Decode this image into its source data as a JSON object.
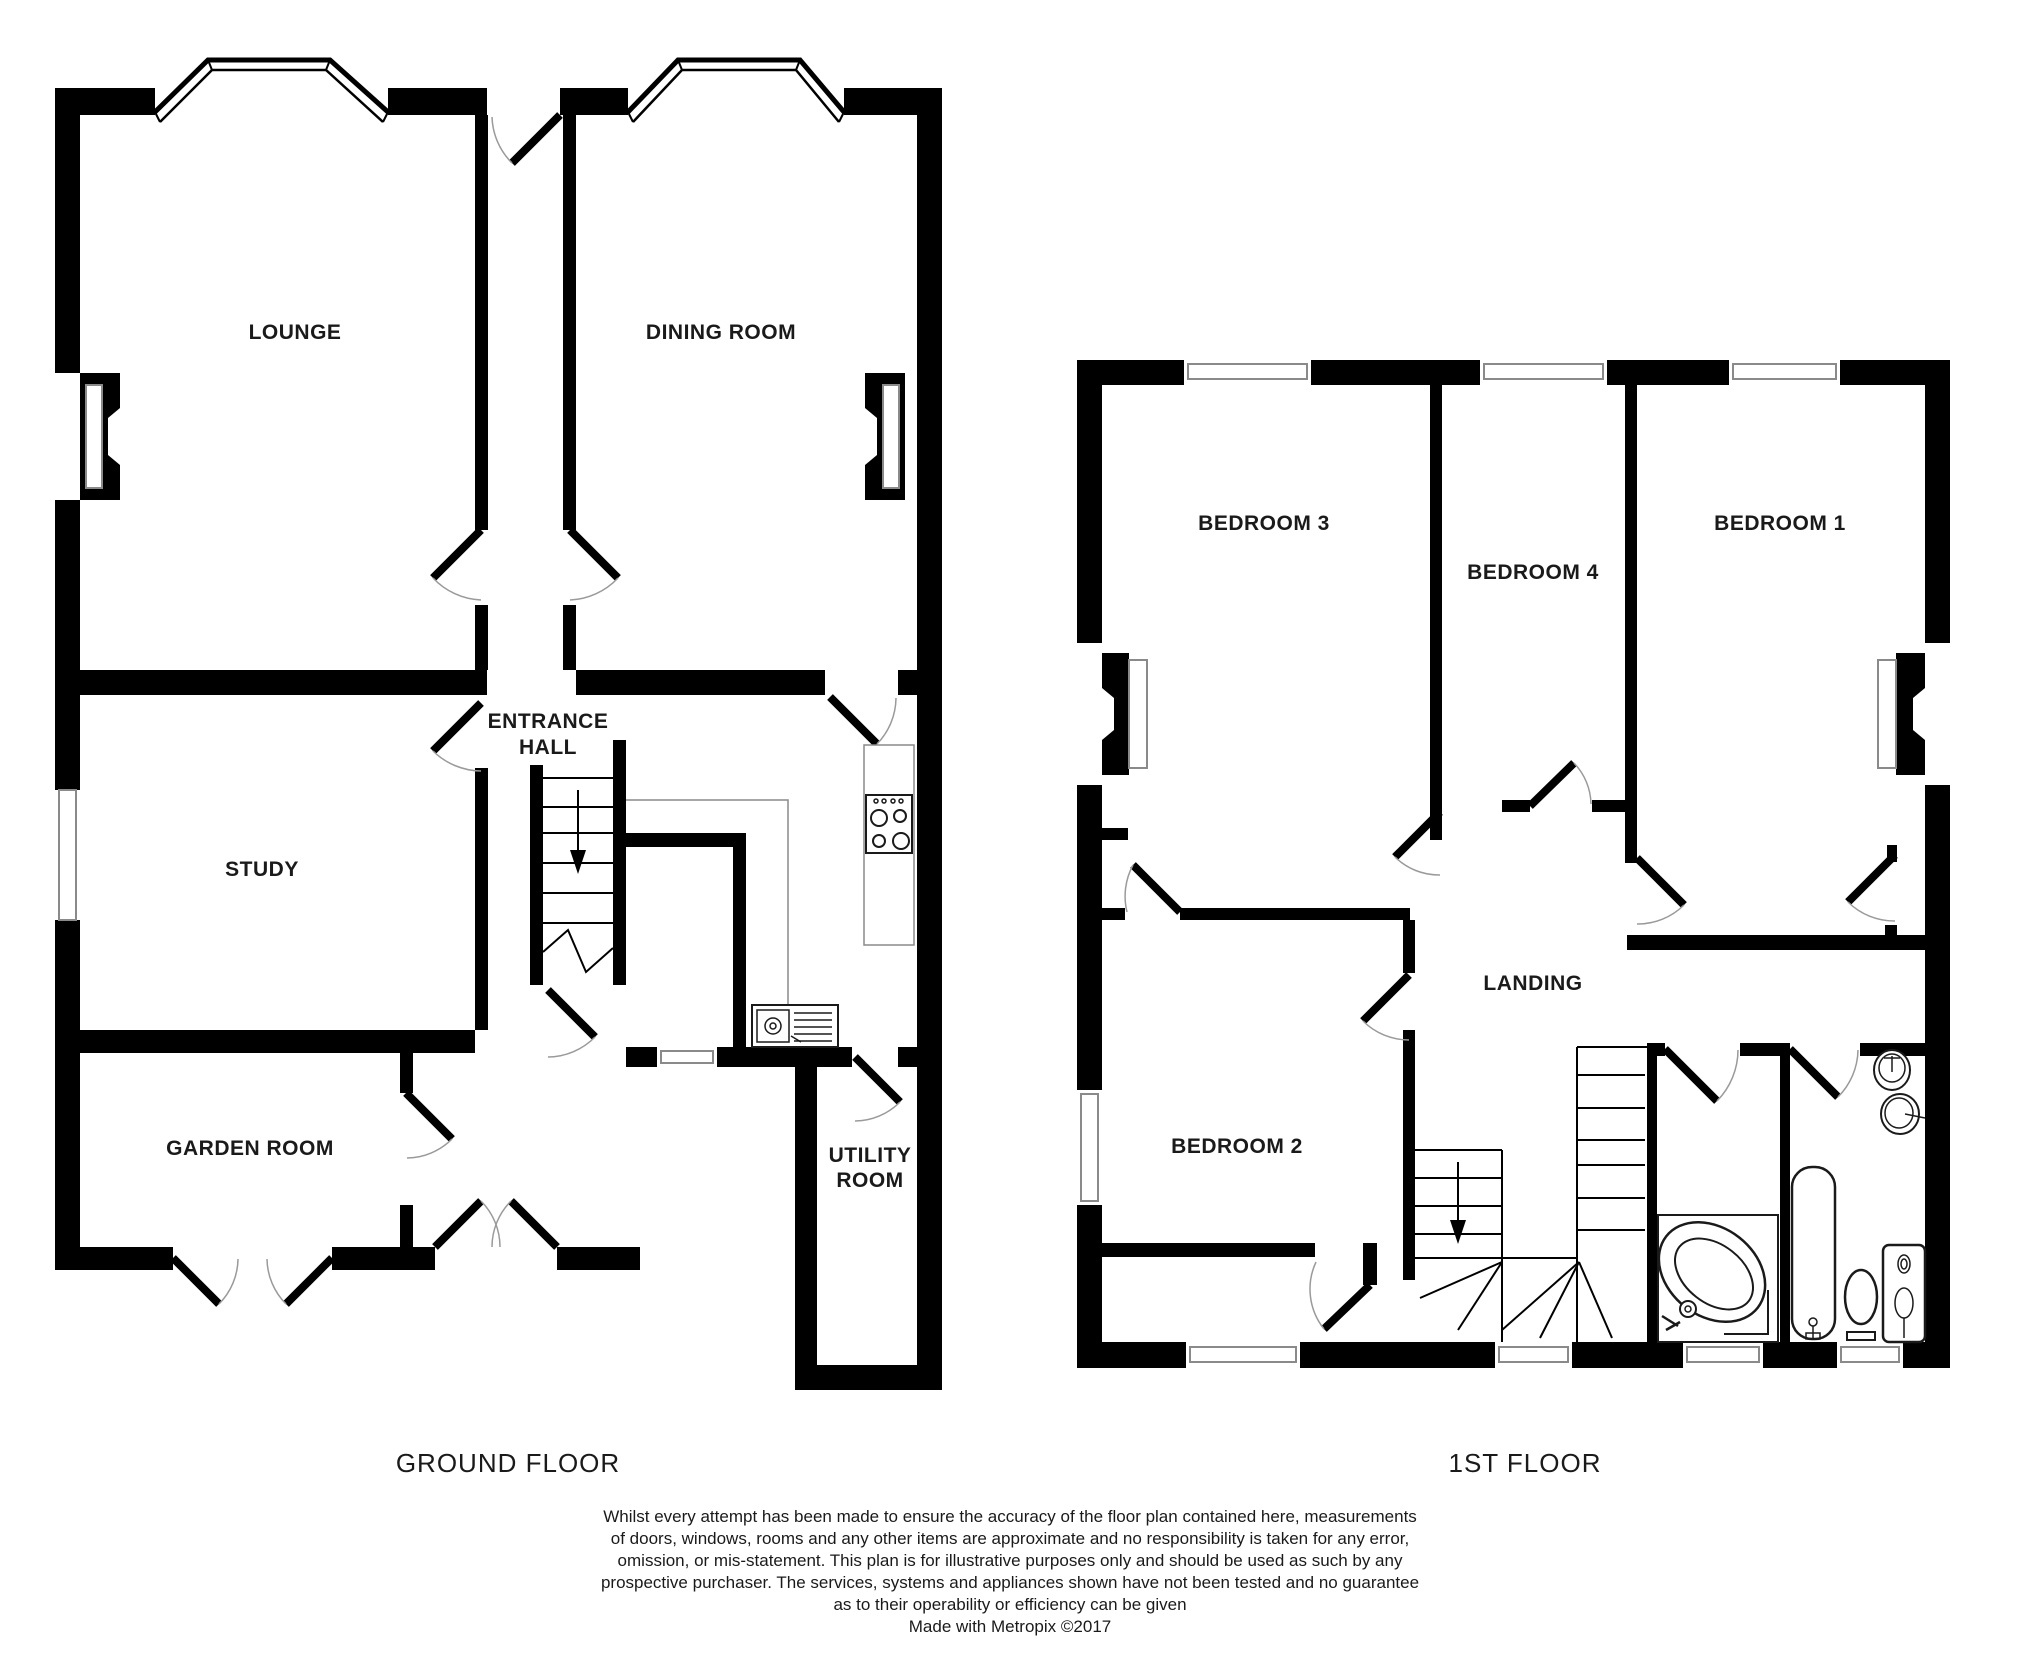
{
  "ground_floor": {
    "label": "GROUND FLOOR",
    "rooms": {
      "lounge": "LOUNGE",
      "dining_room": "DINING ROOM",
      "entrance_hall_line1": "ENTRANCE",
      "entrance_hall_line2": "HALL",
      "study": "STUDY",
      "garden_room": "GARDEN ROOM",
      "utility_room_line1": "UTILITY",
      "utility_room_line2": "ROOM"
    }
  },
  "first_floor": {
    "label": "1ST FLOOR",
    "rooms": {
      "bedroom1": "BEDROOM 1",
      "bedroom2": "BEDROOM 2",
      "bedroom3": "BEDROOM 3",
      "bedroom4": "BEDROOM 4",
      "landing": "LANDING"
    }
  },
  "disclaimer": {
    "line1": "Whilst every attempt has been made to ensure the accuracy of the floor plan contained here, measurements",
    "line2": "of doors, windows, rooms and any other items are approximate and no responsibility is taken for any error,",
    "line3": "omission, or mis-statement. This plan is for illustrative purposes only and should be used as such by any",
    "line4": "prospective purchaser. The services, systems and appliances shown have not been tested and no guarantee",
    "line5": "as to their operability or efficiency can be given",
    "line6": "Made with Metropix ©2017"
  },
  "colors": {
    "background": "#ffffff",
    "wall": "#000000",
    "window_outline": "#8a8a8a",
    "door_arc": "#9a9a9a",
    "counter_outline": "#8a8a8a",
    "fixture_outline": "#1a1a1a",
    "text": "#1a1a1a"
  }
}
